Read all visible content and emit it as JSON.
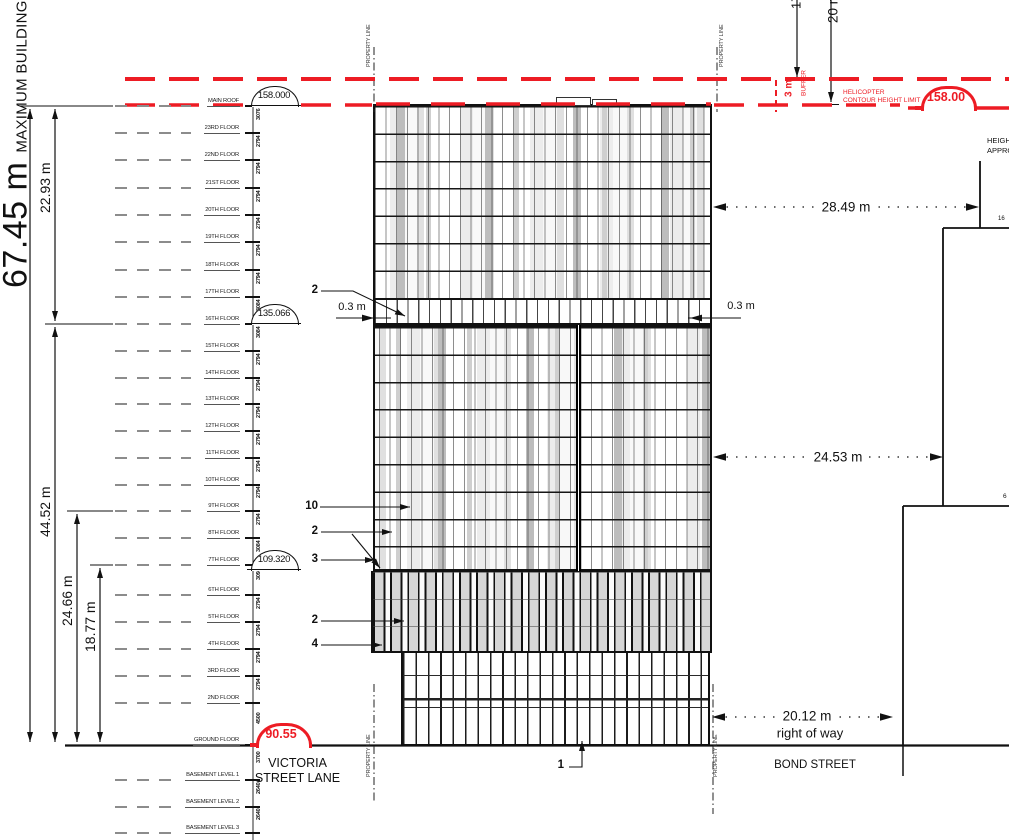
{
  "drawing": {
    "max_height": {
      "value": "67.45 m",
      "caption": "MAXIMUM BUILDING HEIGHT"
    },
    "left_dimensions": [
      {
        "label": "22.93 m",
        "cx": 45,
        "cy": 213
      },
      {
        "label": "44.52 m",
        "cx": 45,
        "cy": 537
      },
      {
        "label": "24.66 m",
        "cx": 67,
        "cy": 626
      },
      {
        "label": "18.77 m",
        "cx": 90,
        "cy": 652
      }
    ],
    "floors": [
      {
        "label": "MAIN ROOF",
        "y": 106,
        "dim": "3076",
        "dashes": true
      },
      {
        "label": "23RD FLOOR",
        "y": 133,
        "dim": "2794",
        "dashes": true
      },
      {
        "label": "22ND FLOOR",
        "y": 160,
        "dim": "2794",
        "dashes": true
      },
      {
        "label": "21ST FLOOR",
        "y": 188,
        "dim": "2794",
        "dashes": true
      },
      {
        "label": "20TH FLOOR",
        "y": 215,
        "dim": "2794",
        "dashes": true
      },
      {
        "label": "19TH FLOOR",
        "y": 242,
        "dim": "2794",
        "dashes": true
      },
      {
        "label": "18TH FLOOR",
        "y": 270,
        "dim": "2794",
        "dashes": true
      },
      {
        "label": "17TH FLOOR",
        "y": 297,
        "dim": "3084",
        "dashes": true
      },
      {
        "label": "16TH FLOOR",
        "y": 324,
        "dim": "3084",
        "dashes": true
      },
      {
        "label": "15TH FLOOR",
        "y": 351,
        "dim": "2794",
        "dashes": true
      },
      {
        "label": "14TH FLOOR",
        "y": 378,
        "dim": "2794",
        "dashes": true
      },
      {
        "label": "13TH FLOOR",
        "y": 404,
        "dim": "2794",
        "dashes": true
      },
      {
        "label": "12TH FLOOR",
        "y": 431,
        "dim": "2794",
        "dashes": true
      },
      {
        "label": "11TH FLOOR",
        "y": 458,
        "dim": "2794",
        "dashes": true
      },
      {
        "label": "10TH FLOOR",
        "y": 485,
        "dim": "2794",
        "dashes": true
      },
      {
        "label": "9TH FLOOR",
        "y": 511,
        "dim": "2794",
        "dashes": true
      },
      {
        "label": "8TH FLOOR",
        "y": 538,
        "dim": "3084",
        "dashes": true
      },
      {
        "label": "7TH FLOOR",
        "y": 565,
        "dim": "3094",
        "dashes": true
      },
      {
        "label": "6TH FLOOR",
        "y": 595,
        "dim": "2794",
        "dashes": true
      },
      {
        "label": "5TH FLOOR",
        "y": 622,
        "dim": "2794",
        "dashes": true
      },
      {
        "label": "4TH FLOOR",
        "y": 649,
        "dim": "2794",
        "dashes": true
      },
      {
        "label": "3RD FLOOR",
        "y": 676,
        "dim": "2794",
        "dashes": true
      },
      {
        "label": "2ND FLOOR",
        "y": 703,
        "dim": "4500",
        "dashes": true
      },
      {
        "label": "GROUND FLOOR",
        "y": 745,
        "dim": "3700",
        "dashes": false
      },
      {
        "label": "BASEMENT LEVEL 1",
        "y": 780,
        "dim": "2640",
        "dashes": true
      },
      {
        "label": "BASEMENT LEVEL 2",
        "y": 807,
        "dim": "2640",
        "dashes": true
      },
      {
        "label": "BASEMENT LEVEL 3",
        "y": 833,
        "dim": null,
        "dashes": true
      }
    ],
    "markers": [
      {
        "value": "158.000",
        "x": 274,
        "y": 106,
        "style": "black"
      },
      {
        "value": "135.066",
        "x": 274,
        "y": 324,
        "style": "black"
      },
      {
        "value": "109.320",
        "x": 274,
        "y": 570,
        "style": "black"
      },
      {
        "value": "90.55",
        "x": 281,
        "y": 745,
        "style": "red"
      },
      {
        "value": "158.00",
        "x": 946,
        "y": 108,
        "style": "red"
      }
    ],
    "callouts": [
      {
        "n": "2",
        "x": 318,
        "y": 291
      },
      {
        "n": "10",
        "x": 318,
        "y": 507
      },
      {
        "n": "2",
        "x": 318,
        "y": 532
      },
      {
        "n": "3",
        "x": 318,
        "y": 560
      },
      {
        "n": "2",
        "x": 318,
        "y": 621
      },
      {
        "n": "4",
        "x": 318,
        "y": 645
      },
      {
        "n": "1",
        "x": 564,
        "y": 766
      }
    ],
    "setback_label": "0.3 m",
    "right_dimensions": [
      {
        "label": "28.49 m",
        "cx": 846,
        "cy": 207
      },
      {
        "label": "24.53 m",
        "cx": 838,
        "cy": 457
      },
      {
        "label": "20.12 m",
        "cx": 807,
        "cy": 716
      }
    ],
    "right_of_way": "right of way",
    "helicopter": {
      "line1": "HELICOPTER",
      "line2": "CONTOUR HEIGHT LIMIT",
      "buffer_value": "3 m",
      "buffer_word": "BUFFER",
      "dim_17": "17",
      "dim_20": "20 m"
    },
    "streets": {
      "victoria_line1": "VICTORIA",
      "victoria_line2": "STREET LANE",
      "bond": "BOND STREET"
    },
    "property_line_label": "PROPERTY LINE",
    "property_label_positions": [
      {
        "x": 369,
        "y": 67
      },
      {
        "x": 722,
        "y": 67
      },
      {
        "x": 369,
        "y": 777
      },
      {
        "x": 716,
        "y": 777
      }
    ],
    "neighbor": {
      "note_line1": "HEIGHT",
      "note_line2": "APPROV",
      "label_16": "16",
      "label_6": "6"
    },
    "colors": {
      "accent_red": "#ed1c24",
      "line": "#111111"
    }
  }
}
